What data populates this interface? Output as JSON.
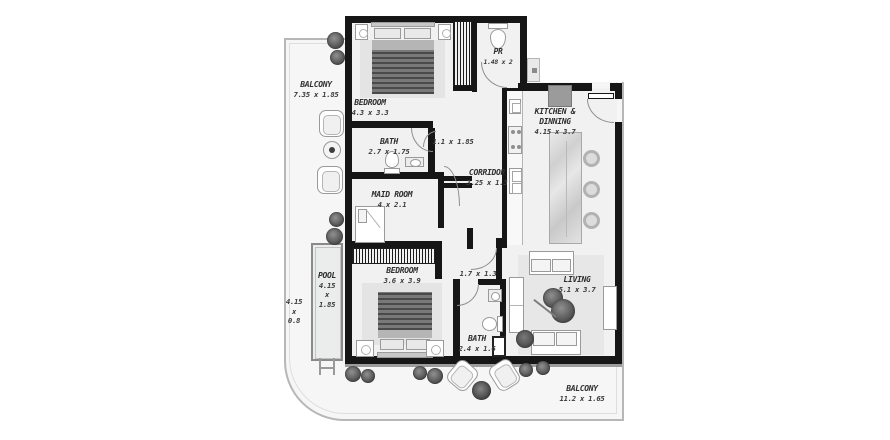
{
  "plan": {
    "type": "apartment-floor-plan",
    "colors": {
      "wall": "#161616",
      "balcony_fill": "#f6f6f6",
      "interior_fill": "#f1f1f1",
      "fridge_gray": "#9b9b9b",
      "label_color": "#2e2e2e"
    },
    "rooms": {
      "balcony_left": {
        "name": "BALCONY",
        "dim": "7.35 x 1.85"
      },
      "bedroom1": {
        "name": "BEDROOM",
        "dim": "4.3 x 3.3"
      },
      "bath1": {
        "name": "BATH",
        "dim": "2.7 x 1.75"
      },
      "hall1": {
        "dim": "1.1 x 1.85"
      },
      "pr": {
        "name": "PR",
        "dim": "1.48 x 2"
      },
      "kitchen": {
        "name_line1": "KITCHEN &",
        "name_line2": "DINNING",
        "dim": "4.15 x 3.7"
      },
      "corridor": {
        "name": "CORRIDOR",
        "dim": "3.25 x 1.3"
      },
      "maid": {
        "name": "MAID ROOM",
        "dim": "4 x 2.1"
      },
      "pool": {
        "name": "POOL",
        "dim_l1": "4.15",
        "dim_l2": "x",
        "dim_l3": "1.85"
      },
      "pool_side": {
        "dim_l1": "4.15",
        "dim_l2": "x",
        "dim_l3": "0.8"
      },
      "bedroom2": {
        "name": "BEDROOM",
        "dim": "3.6 x 3.9"
      },
      "hall2": {
        "dim": "1.7 x 1.3"
      },
      "bath2": {
        "name": "BATH",
        "dim": "2.4 x 1.6"
      },
      "living": {
        "name": "LIVING",
        "dim": "5.1 x 3.7"
      },
      "balcony_bottom": {
        "name": "BALCONY",
        "dim": "11.2 x 1.65"
      }
    }
  }
}
